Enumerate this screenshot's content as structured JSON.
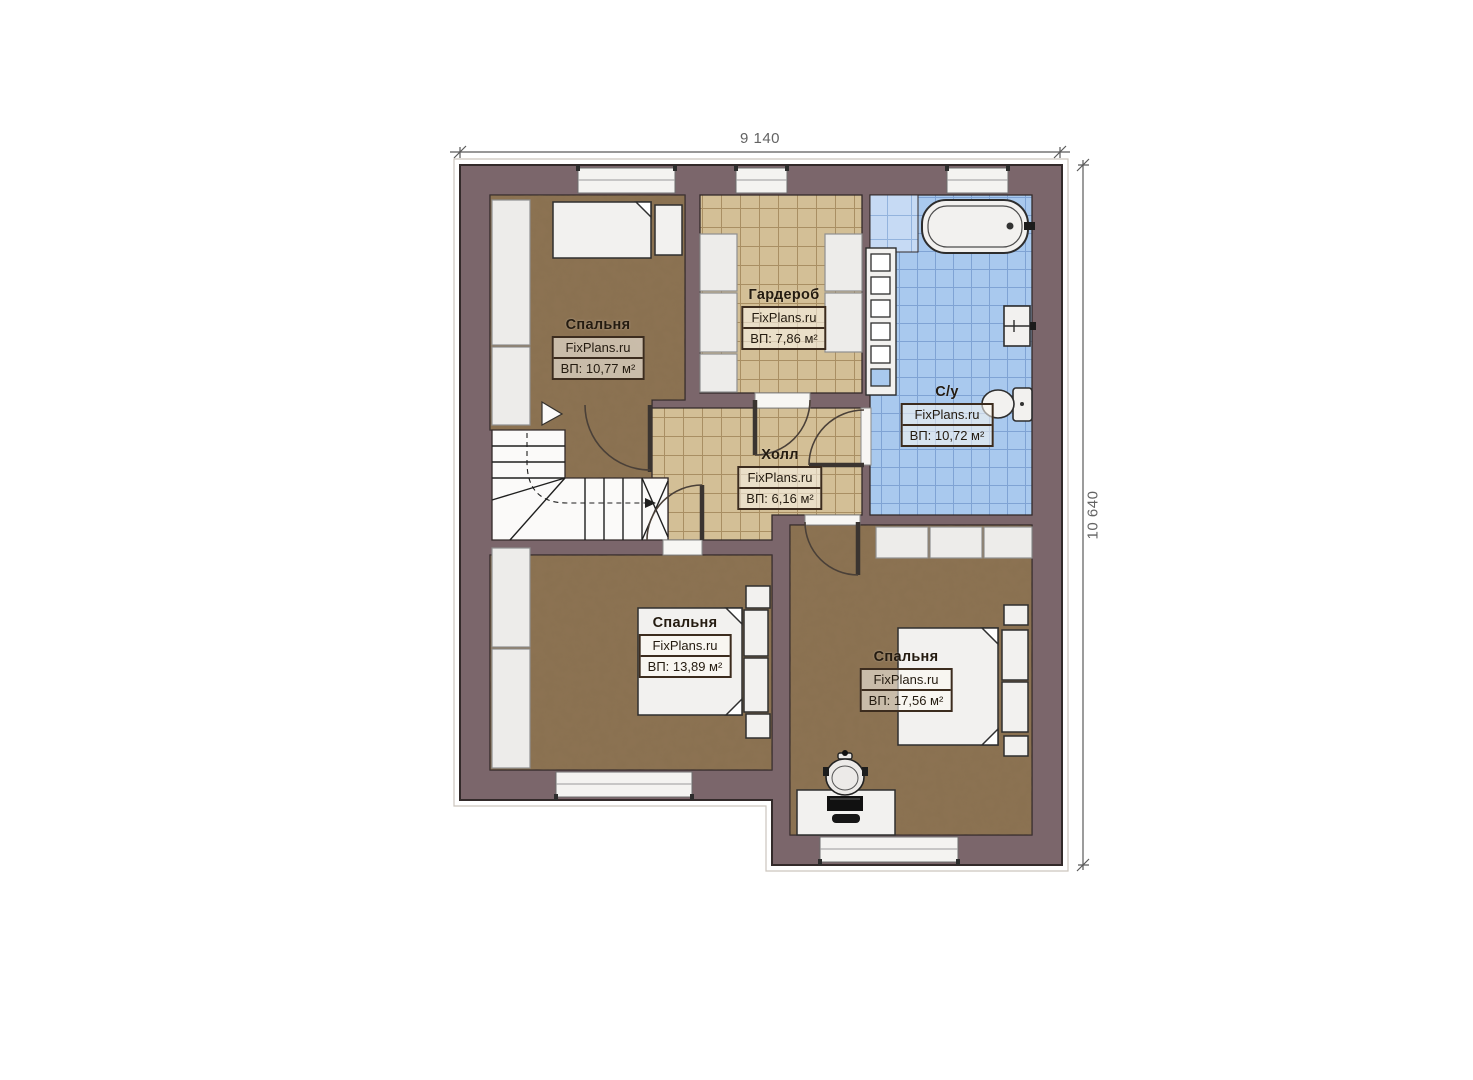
{
  "plan": {
    "dimensions": {
      "width_label": "9 140",
      "height_label": "10 640"
    },
    "rooms": [
      {
        "id": "bedroom-1",
        "name": "Спальня",
        "watermark": "FixPlans.ru",
        "area": "ВП: 10,77 м²"
      },
      {
        "id": "wardrobe",
        "name": "Гардероб",
        "watermark": "FixPlans.ru",
        "area": "ВП: 7,86 м²"
      },
      {
        "id": "bathroom",
        "name": "С/у",
        "watermark": "FixPlans.ru",
        "area": "ВП: 10,72 м²"
      },
      {
        "id": "hall",
        "name": "Холл",
        "watermark": "FixPlans.ru",
        "area": "ВП: 6,16 м²"
      },
      {
        "id": "bedroom-2",
        "name": "Спальня",
        "watermark": "FixPlans.ru",
        "area": "ВП: 13,89 м²"
      },
      {
        "id": "bedroom-3",
        "name": "Спальня",
        "watermark": "FixPlans.ru",
        "area": "ВП: 17,56 м²"
      }
    ],
    "colors": {
      "wall": "#7b666b",
      "bedroom_floor": "#8d7353",
      "tile_floor": "#d3bf96",
      "bath_tile": "#a9c9ee",
      "fixture_white": "#f2f1ef"
    }
  }
}
